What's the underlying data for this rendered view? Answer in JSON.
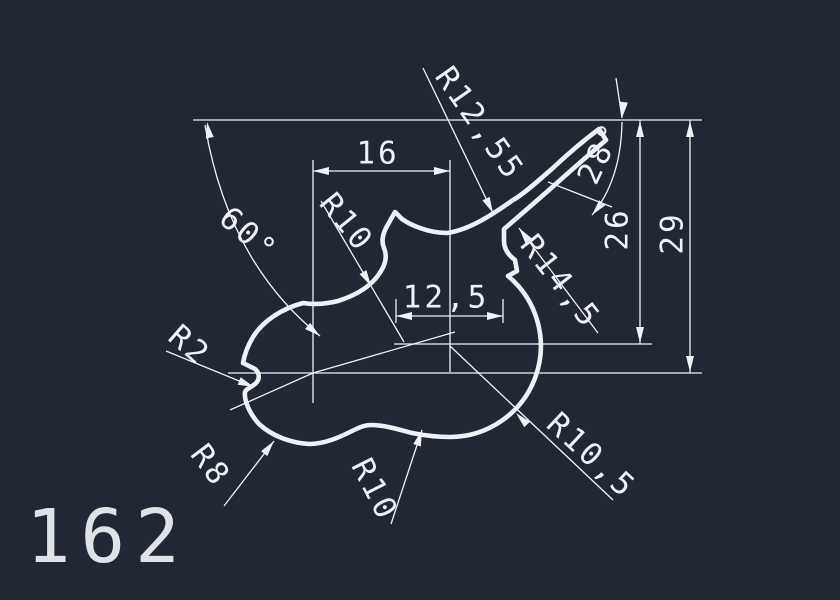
{
  "drawing": {
    "part_number": "162",
    "colors": {
      "background": "#212834",
      "lines": "#eef1f5",
      "part_number": "#dfe3e8"
    },
    "dimensions": {
      "linear": [
        {
          "name": "top-width",
          "value": "16"
        },
        {
          "name": "neck-width",
          "value": "12,5"
        },
        {
          "name": "inner-height",
          "value": "26"
        },
        {
          "name": "outer-height",
          "value": "29"
        }
      ],
      "angular": [
        {
          "name": "left-angle",
          "value": "60°"
        },
        {
          "name": "horn-angle",
          "value": "28°"
        }
      ],
      "radial": [
        {
          "name": "saddle-left-radius",
          "value": "R10"
        },
        {
          "name": "saddle-right-radius",
          "value": "R12,55"
        },
        {
          "name": "horn-lower-radius",
          "value": "R14,5"
        },
        {
          "name": "left-notch-radius",
          "value": "R2"
        },
        {
          "name": "left-lobe-radius",
          "value": "R8"
        },
        {
          "name": "bottom-wave-radius",
          "value": "R10"
        },
        {
          "name": "right-bulge-radius",
          "value": "R10,5"
        }
      ]
    },
    "labels": [
      {
        "text": "16",
        "x": 378,
        "y": 154,
        "rot": 0,
        "size": 31
      },
      {
        "text": "R10",
        "x": 346,
        "y": 223,
        "rot": 51,
        "size": 31
      },
      {
        "text": "R12,55",
        "x": 479,
        "y": 124,
        "rot": 55,
        "size": 31
      },
      {
        "text": "28°",
        "x": 601,
        "y": 153,
        "rot": -65,
        "size": 31
      },
      {
        "text": "26",
        "x": 618,
        "y": 229,
        "rot": -90,
        "size": 31
      },
      {
        "text": "29",
        "x": 673,
        "y": 233,
        "rot": -90,
        "size": 31
      },
      {
        "text": "R14,5",
        "x": 560,
        "y": 282,
        "rot": 52,
        "size": 31
      },
      {
        "text": "12,5",
        "x": 446,
        "y": 298,
        "rot": 0,
        "size": 31
      },
      {
        "text": "60°",
        "x": 248,
        "y": 235,
        "rot": 41,
        "size": 31
      },
      {
        "text": "R2",
        "x": 189,
        "y": 346,
        "rot": 41,
        "size": 31
      },
      {
        "text": "R8",
        "x": 210,
        "y": 466,
        "rot": 53,
        "size": 31
      },
      {
        "text": "R10",
        "x": 374,
        "y": 490,
        "rot": 63,
        "size": 31
      },
      {
        "text": "R10,5",
        "x": 591,
        "y": 456,
        "rot": 43,
        "size": 31
      }
    ],
    "arrows": [
      {
        "x": 207,
        "y": 122,
        "a": -100
      },
      {
        "x": 320,
        "y": 336,
        "a": 39
      },
      {
        "x": 313,
        "y": 171,
        "a": 180
      },
      {
        "x": 450,
        "y": 171,
        "a": 0
      },
      {
        "x": 396,
        "y": 316,
        "a": 180
      },
      {
        "x": 503,
        "y": 316,
        "a": 0
      },
      {
        "x": 640,
        "y": 121,
        "a": -90
      },
      {
        "x": 640,
        "y": 343,
        "a": 90
      },
      {
        "x": 690,
        "y": 121,
        "a": -90
      },
      {
        "x": 690,
        "y": 372,
        "a": 90
      },
      {
        "x": 371,
        "y": 286,
        "a": 60
      },
      {
        "x": 493,
        "y": 213,
        "a": 64
      },
      {
        "x": 519,
        "y": 228,
        "a": -127
      },
      {
        "x": 622,
        "y": 118,
        "a": 97
      },
      {
        "x": 592,
        "y": 215,
        "a": 130
      },
      {
        "x": 254,
        "y": 387,
        "a": 22
      },
      {
        "x": 274,
        "y": 441,
        "a": -52
      },
      {
        "x": 422,
        "y": 430,
        "a": -72
      },
      {
        "x": 516,
        "y": 413,
        "a": -134
      }
    ]
  }
}
